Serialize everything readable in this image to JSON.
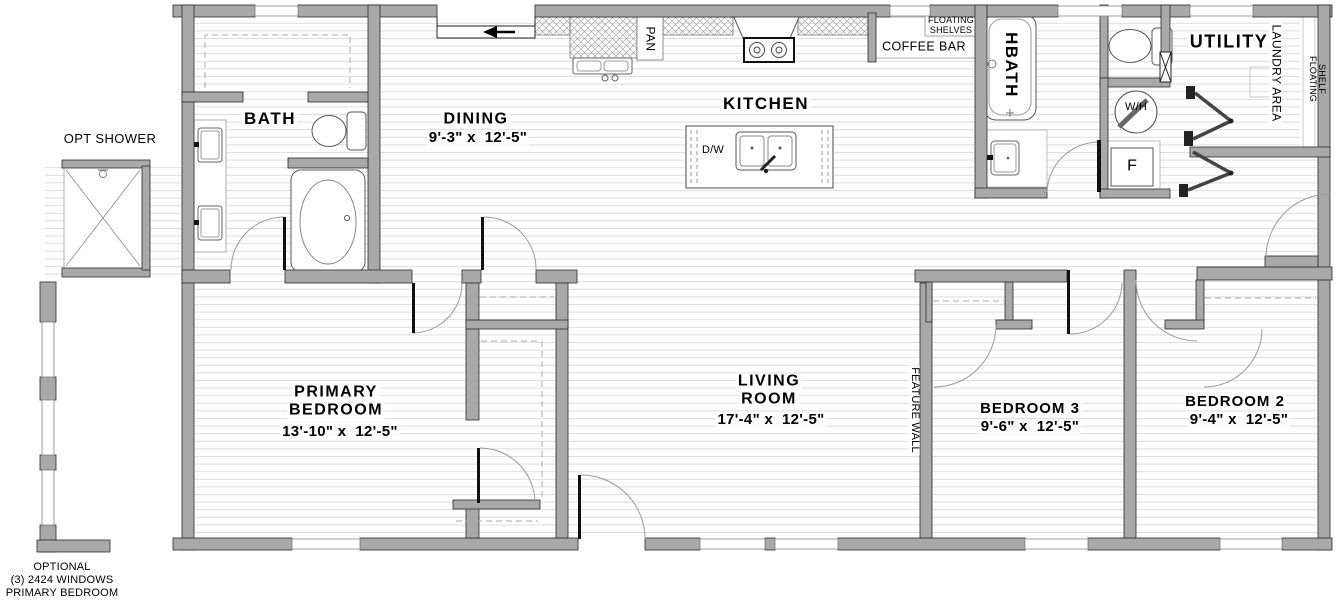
{
  "title": "Floor plan",
  "rooms": {
    "bath": {
      "name": "BATH"
    },
    "dining": {
      "name": "DINING",
      "dims": "9'-3\" x  12'-5\""
    },
    "kitchen": {
      "name": "KITCHEN"
    },
    "hbath": {
      "name": "HBATH"
    },
    "utility": {
      "name": "UTILITY"
    },
    "primary_bedroom": {
      "name_line1": "PRIMARY",
      "name_line2": "BEDROOM",
      "dims": "13'-10\" x  12'-5\""
    },
    "living_room": {
      "name_line1": "LIVING",
      "name_line2": "ROOM",
      "dims": "17'-4\" x  12'-5\""
    },
    "bedroom3": {
      "name": "BEDROOM 3",
      "dims": "9'-6\" x  12'-5\""
    },
    "bedroom2": {
      "name": "BEDROOM 2",
      "dims": "9'-4\" x  12'-5\""
    }
  },
  "annotations": {
    "opt_shower": "OPT SHOWER",
    "floating_shelves_line1": "FLOATING",
    "floating_shelves_line2": "SHELVES",
    "coffee_bar": "COFFEE BAR",
    "pan": "PAN",
    "dishwasher": "D/W",
    "laundry_area": "LAUNDRY AREA",
    "floating_shelf_line1": "FLOATING",
    "floating_shelf_line2": "SHELF",
    "water_heater": "W/H",
    "furnace": "F",
    "feature_wall": "FEATURE WALL",
    "optional_line1": "OPTIONAL",
    "optional_line2": "(3) 2424 WINDOWS",
    "optional_line3": "PRIMARY BEDROOM"
  },
  "colors": {
    "background": "#ffffff",
    "wall_fill": "#a9a9a9",
    "wall_stroke": "#2a2a2a",
    "floor_line": "#dcdcdc",
    "hatch": "#9a9a9a",
    "door_arc": "#9a9a9a",
    "text": "#000000"
  }
}
